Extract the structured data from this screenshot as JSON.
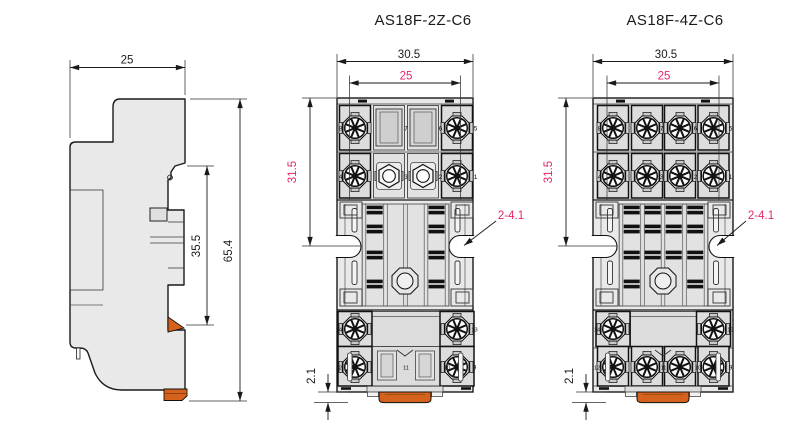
{
  "colors": {
    "dim_accent": "#e6256e",
    "clip_orange": "#d4611c",
    "body_gray": "#e9e9e9",
    "line": "#1a1a1a"
  },
  "side_view": {
    "width_mm": "25",
    "rail_height_mm": "35.5",
    "total_height_mm": "65.4"
  },
  "front_2z": {
    "title": "AS18F-2Z-C6",
    "overall_width": "30.5",
    "pitch": "25",
    "mount_height": "31.5",
    "mount_holes": "2-4.1",
    "clip_drop": "2.1",
    "terminals": {
      "row1": [
        "8",
        "7",
        "6",
        "5"
      ],
      "row2": [
        "4",
        "3",
        "2",
        "1"
      ],
      "row3": [
        "14",
        "13"
      ],
      "row4": [
        "12",
        "11",
        "10",
        "9"
      ]
    }
  },
  "front_4z": {
    "title": "AS18F-4Z-C6",
    "overall_width": "30.5",
    "pitch": "25",
    "mount_height": "31.5",
    "mount_holes": "2-4.1",
    "clip_drop": "2.1",
    "terminals": {
      "row1": [
        "8",
        "7",
        "6",
        "5"
      ],
      "row2": [
        "4",
        "3",
        "2",
        "1"
      ],
      "row3": [
        "14",
        "13"
      ],
      "row4": [
        "12",
        "11",
        "10",
        "9"
      ]
    }
  }
}
